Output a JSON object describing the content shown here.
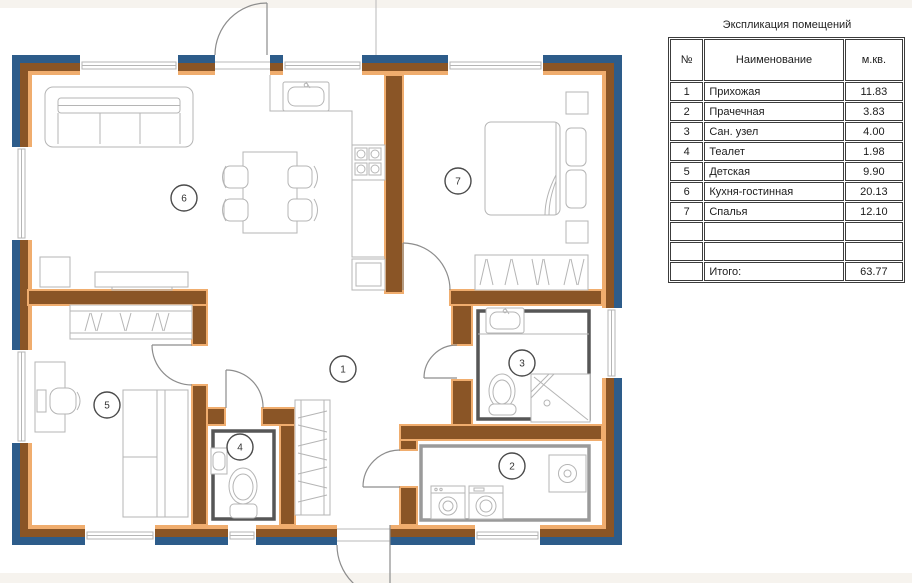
{
  "explication": {
    "title": "Экспликация помещений",
    "headers": {
      "no": "№",
      "name": "Наименование",
      "area": "м.кв."
    },
    "rows": [
      {
        "no": "1",
        "name": "Прихожая",
        "area": "11.83"
      },
      {
        "no": "2",
        "name": "Прачечная",
        "area": "3.83"
      },
      {
        "no": "3",
        "name": "Сан. узел",
        "area": "4.00"
      },
      {
        "no": "4",
        "name": "Теалет",
        "area": "1.98"
      },
      {
        "no": "5",
        "name": "Детская",
        "area": "9.90"
      },
      {
        "no": "6",
        "name": "Кухня-гостинная",
        "area": "20.13"
      },
      {
        "no": "7",
        "name": "Спалья",
        "area": "12.10"
      },
      {
        "no": "",
        "name": "",
        "area": ""
      },
      {
        "no": "",
        "name": "",
        "area": ""
      },
      {
        "no": "",
        "name": "Итого:",
        "area": "63.77"
      }
    ]
  },
  "plan": {
    "room_markers": [
      "1",
      "2",
      "3",
      "4",
      "5",
      "6",
      "7"
    ]
  },
  "colors": {
    "wall-blue": "#2d5c8a",
    "wall-brown": "#8a5526",
    "wall-tan": "#f0ad6e",
    "wet-liner": "#565656",
    "laundry-liner": "#9a9a9a",
    "furniture-line": "#b5b5b5",
    "door-line": "#8d8d8d",
    "marker-line": "#4a4a4a",
    "band-bg": "#f6f3ee",
    "table-border": "#3c3c3c"
  }
}
